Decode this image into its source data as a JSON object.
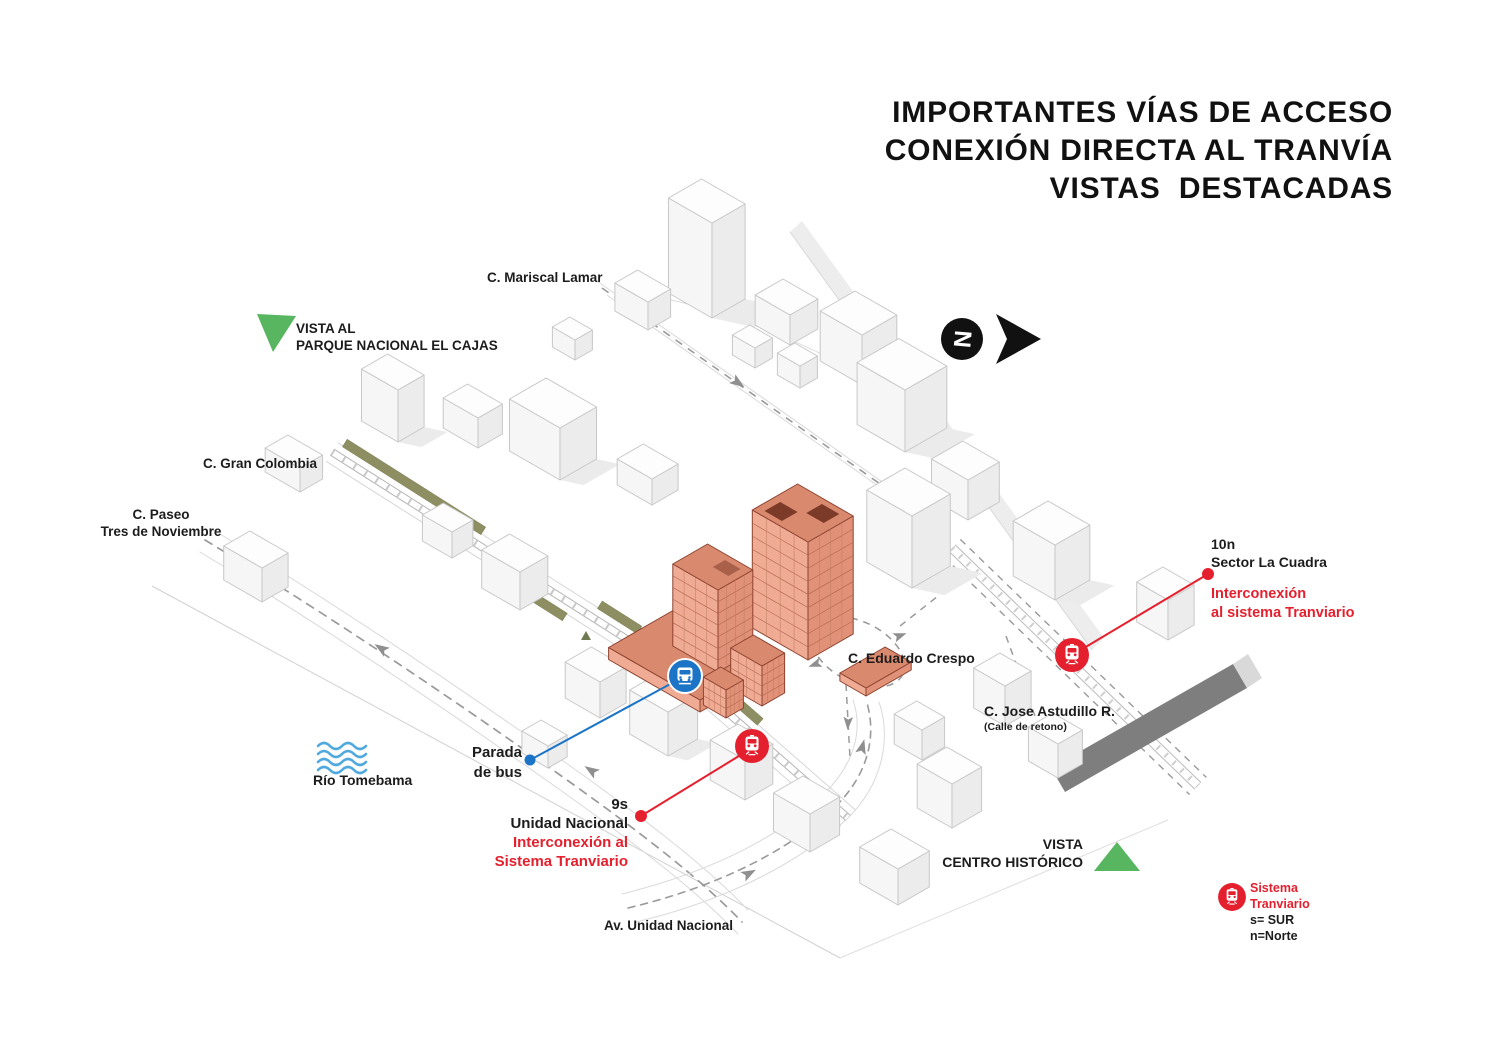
{
  "title": {
    "line1": "IMPORTANTES VÍAS DE ACCESO",
    "line2": "CONEXIÓN DIRECTA AL TRANVÍA",
    "line3": "VISTAS  DESTACADAS"
  },
  "north": {
    "letter": "N"
  },
  "views": {
    "cajas": {
      "line1": "VISTA AL",
      "line2": "PARQUE NACIONAL EL CAJAS"
    },
    "centro": {
      "line1": "VISTA",
      "line2": "CENTRO HISTÓRICO"
    }
  },
  "streets": {
    "mariscal_lamar": "C. Mariscal Lamar",
    "gran_colombia": "C. Gran Colombia",
    "paseo_line1": "C. Paseo",
    "paseo_line2": "Tres de Noviembre",
    "eduardo_crespo": "C. Eduardo Crespo",
    "jose_astudillo": "C. Jose Astudillo R.",
    "jose_astudillo_sub": "(Calle de retono)",
    "av_unidad_nacional": "Av. Unidad Nacional"
  },
  "river": {
    "label": "Río Tomebama"
  },
  "bus_stop": {
    "line1": "Parada",
    "line2": "de bus"
  },
  "tram_stop_south": {
    "code": "9s",
    "name": "Unidad Nacional",
    "note_line1": "Interconexión al",
    "note_line2": "Sistema Tranviario"
  },
  "tram_stop_north": {
    "code": "10n",
    "name": "Sector La Cuadra",
    "note_line1": "Interconexión",
    "note_line2": "al sistema Tranviario"
  },
  "legend": {
    "line1": "Sistema",
    "line2": "Tranviario",
    "south": "s= SUR",
    "north": "n=Norte"
  },
  "colors": {
    "red": "#E5202E",
    "blue": "#1B74C5",
    "light_blue": "#4FA9DE",
    "green": "#57B65F",
    "olive": "#8D8E62",
    "terracotta_light": "#F0AB94",
    "terracotta_mid": "#E09177",
    "terracotta_dark": "#8D4330",
    "slope_gray": "#7E7E7E"
  }
}
